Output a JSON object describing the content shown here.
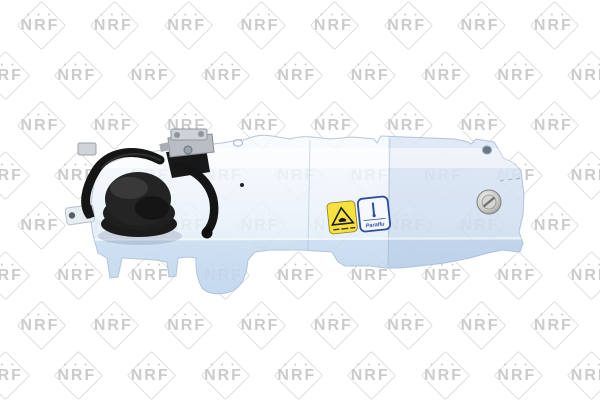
{
  "window": {
    "width": 600,
    "height": 400,
    "background": "#ffffff"
  },
  "watermark": {
    "text": "NRF",
    "dots": "• • •",
    "color": "#cbcbcb",
    "diamond_color": "#dedede"
  },
  "product": {
    "type": "coolant-expansion-tank",
    "body_color_top": "#f7fafd",
    "body_color_bottom": "#cfe1f3",
    "cap_color": "#1b1b1b",
    "hose_color": "#151515",
    "bracket_color": "#c3c8cd",
    "plug_color": "#c9c9c6",
    "labels": {
      "warning": {
        "background": "#f7e13e",
        "symbol": "hot-liquid-warning-triangle",
        "border": "#55511d"
      },
      "coolant": {
        "text": "Paraflu",
        "background": "#f5f8fc",
        "border": "#2b4e9e"
      }
    }
  }
}
